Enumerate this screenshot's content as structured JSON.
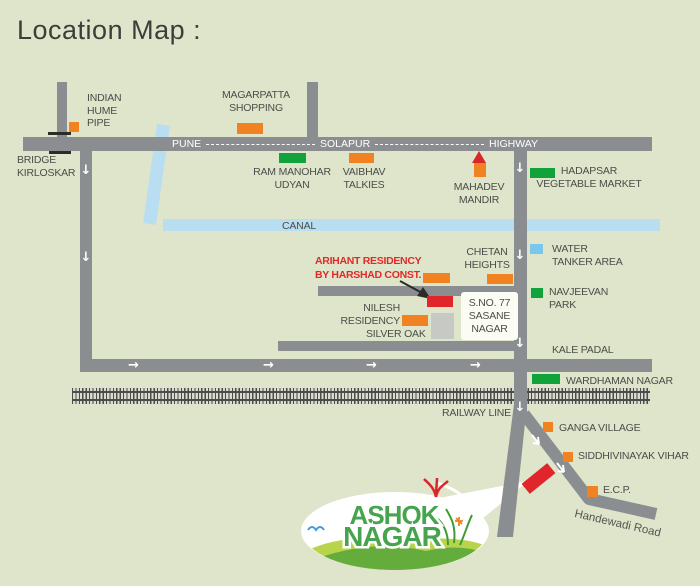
{
  "title": "Location Map :",
  "highway": {
    "from": "PUNE",
    "via": "SOLAPUR",
    "label": "HIGHWAY"
  },
  "canal": {
    "label": "CANAL"
  },
  "railway": {
    "label": "RAILWAY LINE"
  },
  "bridge": {
    "l1": "BRIDGE",
    "l2": "KIRLOSKAR"
  },
  "landmarks": {
    "indian_hume_pipe": {
      "l1": "INDIAN",
      "l2": "HUME",
      "l3": "PIPE"
    },
    "magarpatta": {
      "l1": "MAGARPATTA",
      "l2": "SHOPPING"
    },
    "ram_manohar": {
      "l1": "RAM MANOHAR",
      "l2": "UDYAN"
    },
    "vaibhav": {
      "l1": "VAIBHAV",
      "l2": "TALKIES"
    },
    "mahadev": {
      "l1": "MAHADEV",
      "l2": "MANDIR"
    },
    "hadapsar": {
      "l1": "HADAPSAR",
      "l2": "VEGETABLE MARKET"
    },
    "water_tanker": {
      "l1": "WATER",
      "l2": "TANKER AREA"
    },
    "chetan": {
      "l1": "CHETAN",
      "l2": "HEIGHTS"
    },
    "nilesh": {
      "l1": "NILESH",
      "l2": "RESIDENCY"
    },
    "silver_oak": {
      "l1": "SILVER OAK"
    },
    "sasane": {
      "l1": "S.NO. 77",
      "l2": "SASANE",
      "l3": "NAGAR"
    },
    "navjeevan": {
      "l1": "NAVJEEVAN",
      "l2": "PARK"
    },
    "kale_padal": {
      "l1": "KALE PADAL"
    },
    "wardhaman": {
      "l1": "WARDHAMAN NAGAR"
    },
    "ganga": {
      "l1": "GANGA VILLAGE"
    },
    "siddhivinayak": {
      "l1": "SIDDHIVINAYAK VIHAR"
    },
    "ecp": {
      "l1": "E.C.P."
    },
    "handewadi": {
      "l1": "Handewadi Road"
    }
  },
  "site": {
    "l1": "ARIHANT RESIDENCY",
    "l2": "BY HARSHAD CONST."
  },
  "logo": {
    "l1": "ASHOK",
    "l2": "NAGAR"
  },
  "colors": {
    "background": "#dfe5cb",
    "road_gray": "#8b8e91",
    "orange_marker": "#f08222",
    "green_marker": "#12a23c",
    "red_marker": "#e0262b",
    "canal_blue": "#b9def2",
    "water_blue": "#79c7ec",
    "logo_green": "#46a34e",
    "red_text": "#e12a28"
  }
}
